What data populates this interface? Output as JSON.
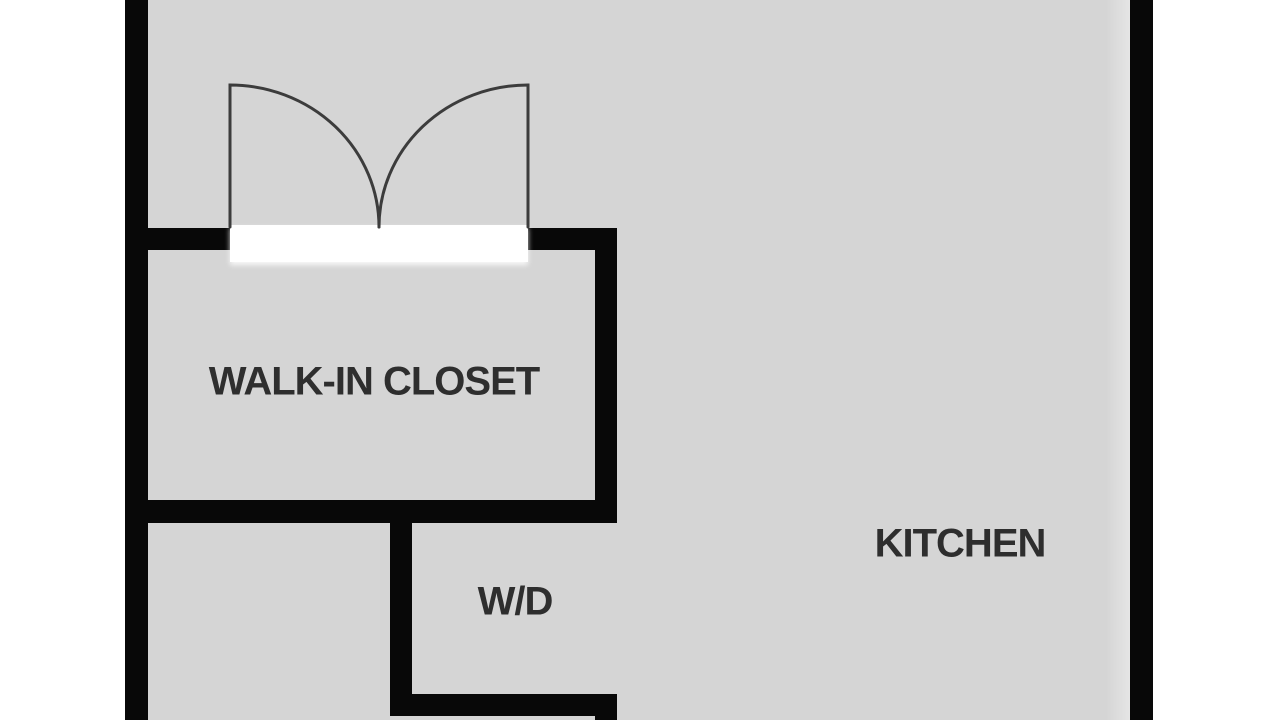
{
  "plan": {
    "title": "floor-plan-crop",
    "rooms": {
      "walk_in_closet": {
        "label": "WALK-IN CLOSET"
      },
      "wd": {
        "label": "W/D"
      },
      "kitchen": {
        "label": "KITCHEN"
      }
    },
    "door": {
      "type": "double-swing-door",
      "leaf_count": 2,
      "location": "walk-in-closet-top-wall"
    },
    "colors": {
      "outside": "#ffffff",
      "floor": "#d5d5d5",
      "wall": "#080808",
      "label": "#2e2e2e",
      "door_line": "#3c3c3c",
      "door_gap": "#ffffff",
      "wall_shade": "#e5e5e5"
    }
  }
}
